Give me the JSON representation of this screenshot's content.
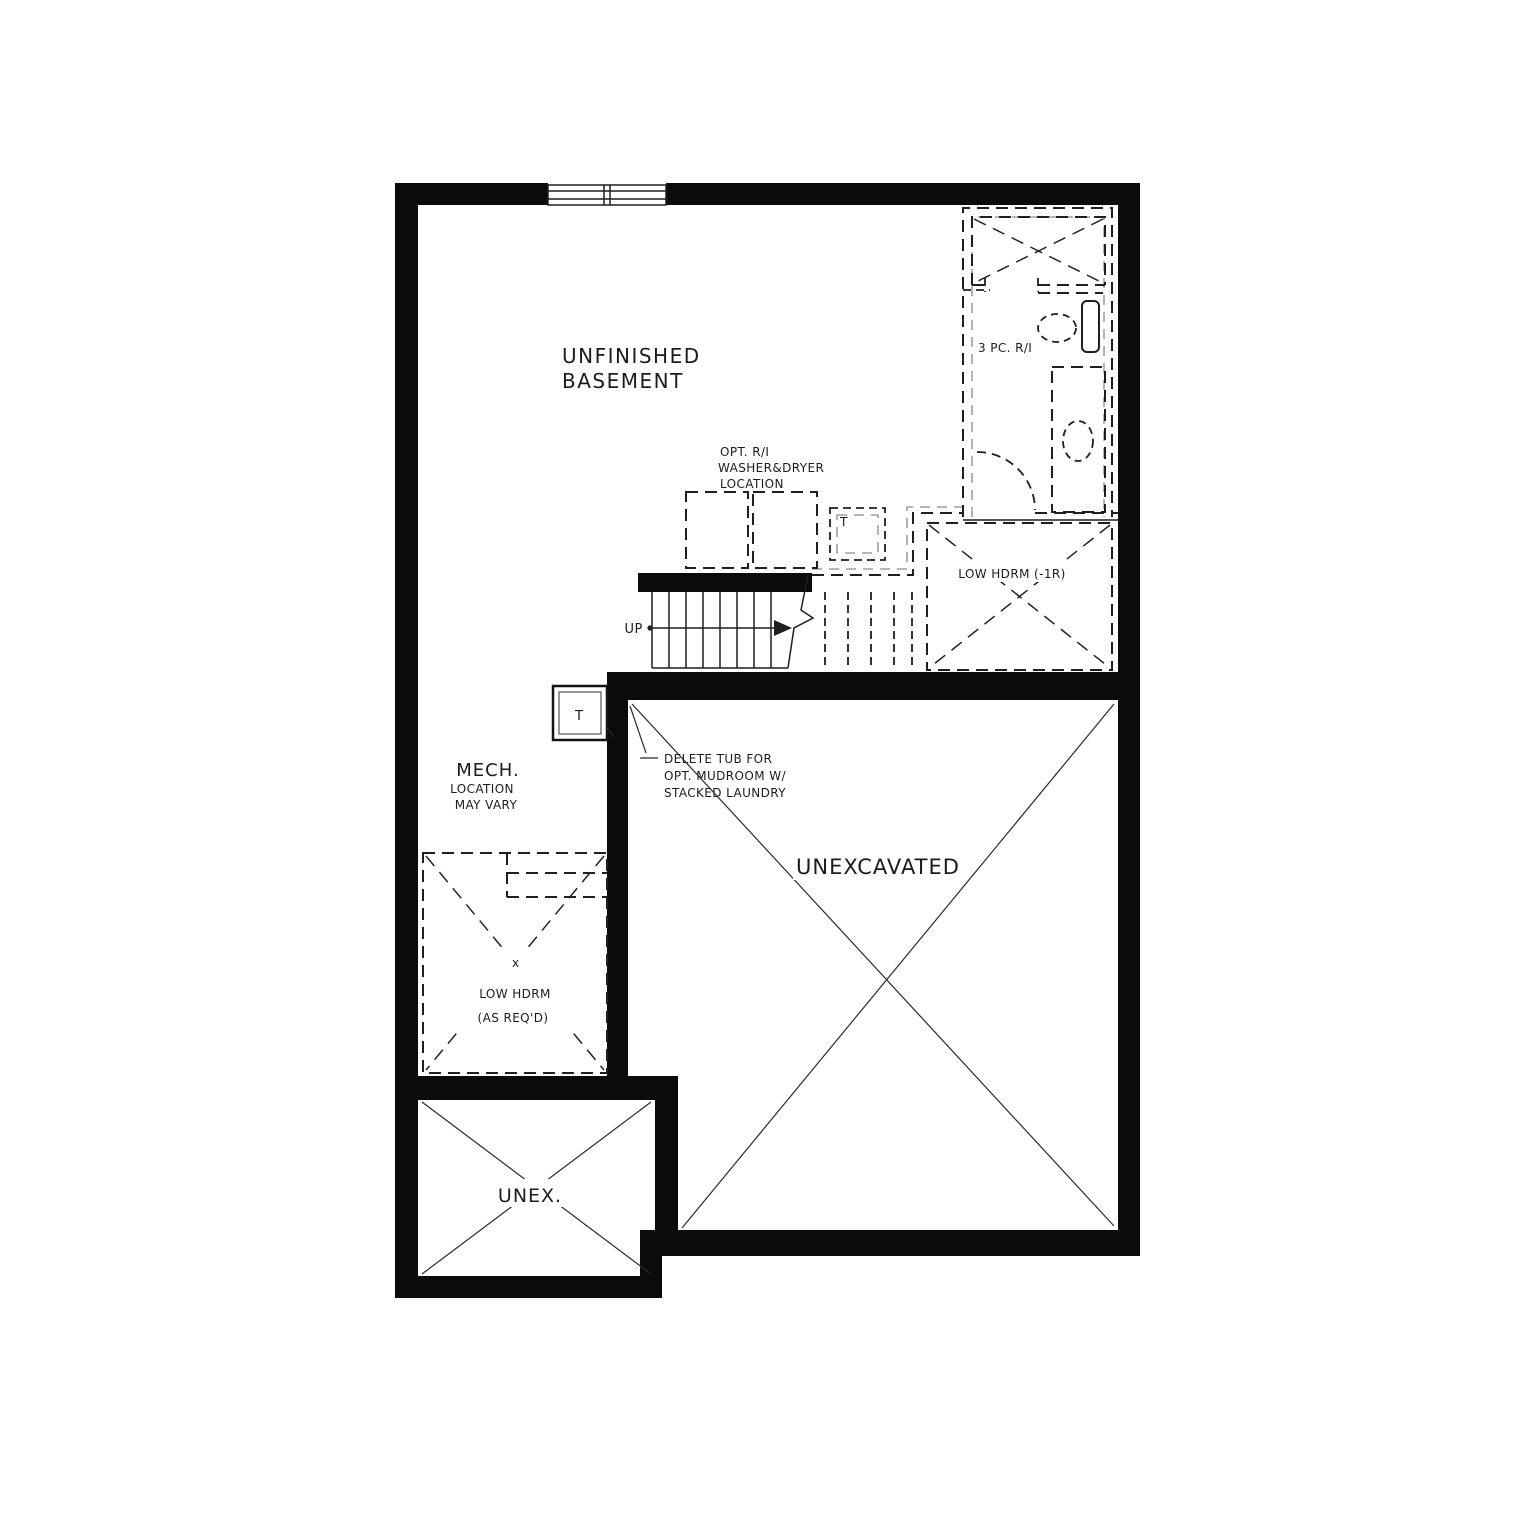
{
  "plan": {
    "type": "architectural-floor-plan",
    "colors": {
      "wall": "#0b0b0b",
      "line": "#1f1f1f",
      "background": "#ffffff"
    },
    "labels": {
      "unfinished_basement": {
        "line1": "UNFINISHED",
        "line2": "BASEMENT"
      },
      "washer_dryer_note": {
        "line1": "OPT. R/I",
        "line2": "WASHER&DRYER",
        "line3": "LOCATION"
      },
      "bathroom": {
        "label": "3 PC. R/I"
      },
      "low_hdrm_stairs": {
        "label": "LOW HDRM (-1R)"
      },
      "stairs": {
        "up": "UP"
      },
      "t_marker_corridor": {
        "label": "T"
      },
      "t_marker_mech": {
        "label": "T"
      },
      "mech_note": {
        "line1": "MECH.",
        "line2": "LOCATION",
        "line3": "MAY VARY"
      },
      "delete_tub_note": {
        "line1": "DELETE TUB FOR",
        "line2": "OPT. MUDROOM W/",
        "line3": "STACKED LAUNDRY"
      },
      "unexcavated": {
        "label": "UNEXCAVATED"
      },
      "low_hdrm_mech": {
        "marker": "x",
        "line1": "LOW HDRM",
        "line2": "(AS REQ'D)"
      },
      "unex_small": {
        "label": "UNEX."
      }
    }
  }
}
